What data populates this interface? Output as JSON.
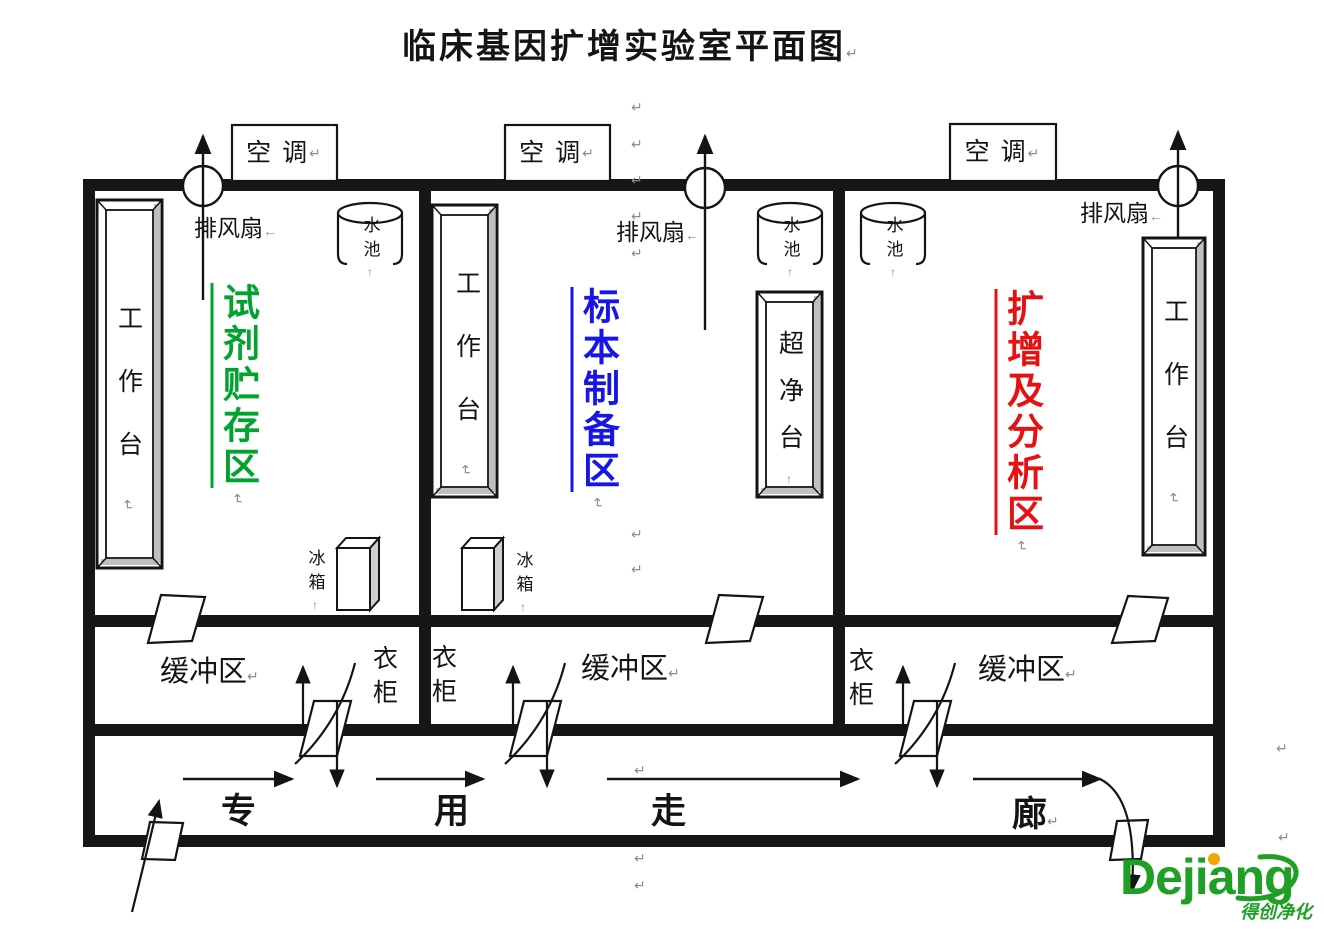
{
  "title": "临床基因扩增实验室平面图",
  "marks": {
    "return": "↵",
    "left_arrow": "←",
    "up_arrow": "↑"
  },
  "labels": {
    "air_conditioner": "空 调",
    "exhaust_fan": "排风扇",
    "sink": "水池",
    "workbench": "工作台",
    "clean_bench": "超净台",
    "fridge": "冰箱",
    "wardrobe": "衣柜",
    "buffer_zone": "缓冲区"
  },
  "zones": [
    {
      "name": "试剂贮存区",
      "color": "#00A32E"
    },
    {
      "name": "标本制备区",
      "color": "#1616E8"
    },
    {
      "name": "扩增及分析区",
      "color": "#E81010"
    }
  ],
  "corridor": {
    "name": "专用走廊",
    "chars": [
      "专",
      "用",
      "走",
      "廊"
    ]
  },
  "logo": {
    "brand": "Dejiang",
    "tagline": "得创净化",
    "brand_color": "#1FA024",
    "dot_color": "#F5A300"
  }
}
